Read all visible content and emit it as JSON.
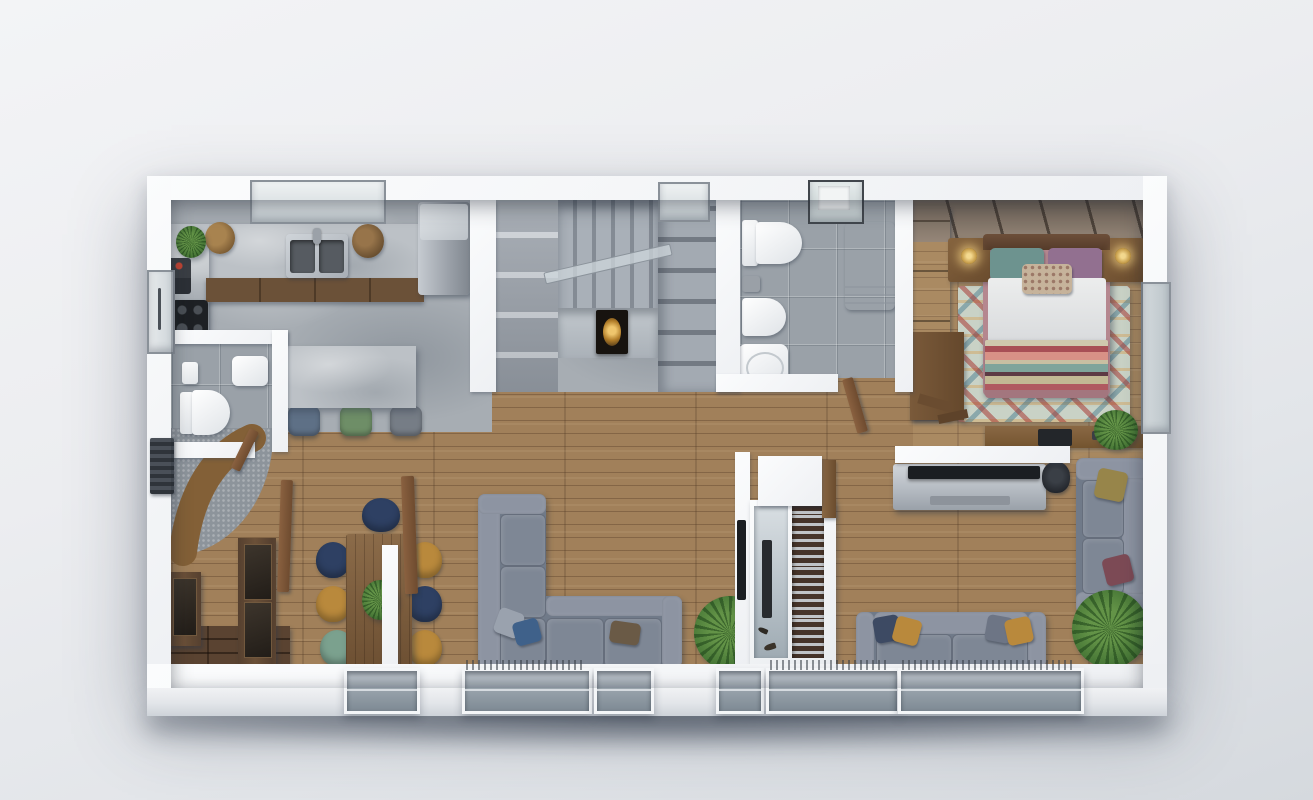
{
  "canvas": {
    "width": 1313,
    "height": 800
  },
  "scene": {
    "type": "3d-floor-plan-render",
    "view": "top-down photoreal architectural visualization of a single-storey apartment",
    "background": "plain light studio gray with soft drop shadow under the model",
    "rooms": [
      {
        "name": "kitchen",
        "floor": "polished concrete",
        "furniture": [
          "l-shaped concrete counter",
          "double steel sink with faucet",
          "black induction cooktop",
          "steel fridge",
          "concrete island",
          "three bar stools (blue, green, gray)",
          "potted plant",
          "wicker baskets",
          "log bin",
          "small dark appliance"
        ]
      },
      {
        "name": "wc",
        "floor": "gray tile",
        "furniture": [
          "wall-hung toilet",
          "washbasin",
          "toilet accessories",
          "wooden door"
        ]
      },
      {
        "name": "staircase",
        "floor": "gray concrete",
        "furniture": [
          "upper flight of treads",
          "shelf-like lower steps",
          "glass railing",
          "under-stair alcove with gilt-framed artwork"
        ]
      },
      {
        "name": "bathroom",
        "floor": "gray tile",
        "furniture": [
          "toilet",
          "bidet",
          "washbasin",
          "washing machine",
          "skylight window",
          "wooden door"
        ]
      },
      {
        "name": "bedroom",
        "floor": "oak planks",
        "furniture": [
          "double bed with striped boho blanket",
          "teal pillow",
          "mauve pillow",
          "patterned accent pillow",
          "two wooden nightstands",
          "two brass lamps",
          "upholstered headboard wall panels",
          "tall wardrobe",
          "multicolor boho rug",
          "desk with laptop",
          "potted plant"
        ]
      },
      {
        "name": "entry",
        "floor": "mosaic tile",
        "furniture": [
          "curved rattan bench",
          "wall radiator",
          "dark wardrobe with smoked-glass doors",
          "pivot wood door"
        ]
      },
      {
        "name": "dining",
        "floor": "oak planks",
        "furniture": [
          "walnut dining table",
          "plant centerpiece",
          "seven shell chairs (navy, mustard, teal)",
          "sliding wood door"
        ]
      },
      {
        "name": "living",
        "floor": "oak planks",
        "furniture": [
          "l-shaped gray sectional sofa",
          "scatter pillows",
          "palm plant",
          "tv on partition wall"
        ]
      },
      {
        "name": "tv-lounge",
        "floor": "oak planks",
        "furniture": [
          "tv media console",
          "wall tv",
          "two gray sofas with pillows",
          "palm plant",
          "desk chair",
          "room divider with aquarium and bookshelf"
        ]
      }
    ],
    "window_count": {
      "top_wall": 3,
      "bottom_wall": 6,
      "left_wall": 1,
      "right_wall": 1
    }
  },
  "palette": {
    "wood": "#a1805a",
    "wood-bed": "#ab8960",
    "concrete": "#a7adb3",
    "slab": "#bcc1c6",
    "tile": "#9aa1a8",
    "mosaic": "#8d949b",
    "sofa": "#7e8795",
    "sofa-base": "#707a89",
    "sofa-light": "#8d94a2",
    "walnut": "#55402f",
    "table": "#7b5a39",
    "navy": "#2e4063",
    "mustard": "#b9893c",
    "teal-chair": "#7ba18e",
    "bed-frame": "#b5878f",
    "pillow-teal": "#6d938f",
    "pillow-mauve": "#927090",
    "pillow-accent": "#c6b39b",
    "rug": "#c9d2c6",
    "headboard": "#8c7c6d",
    "plant1": "#4a7a38",
    "plant2": "#639347",
    "rattan": "#a57c4b",
    "steel": "#b5bac1",
    "tv": "#1b1e22",
    "gold": "#d1a54f",
    "glass": "#dfe4e7"
  }
}
